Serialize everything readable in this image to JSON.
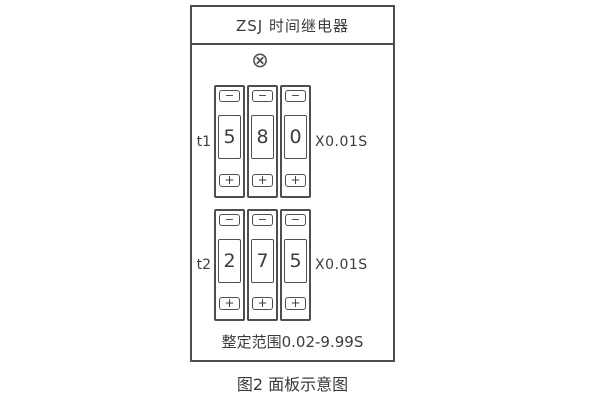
{
  "panel": {
    "title": "ZSJ 时间继电器",
    "lamp_symbol": "⊗",
    "range_text": "整定范围0.02-9.99S"
  },
  "rows": [
    {
      "label": "t1",
      "digits": [
        "5",
        "8",
        "0"
      ],
      "multiplier": "X0.01S"
    },
    {
      "label": "t2",
      "digits": [
        "2",
        "7",
        "5"
      ],
      "multiplier": "X0.01S"
    }
  ],
  "controls": {
    "minus": "−",
    "plus": "+"
  },
  "caption": "图2 面板示意图",
  "colors": {
    "line": "#4e4e4e",
    "text": "#3c3c3c",
    "background": "#ffffff"
  }
}
